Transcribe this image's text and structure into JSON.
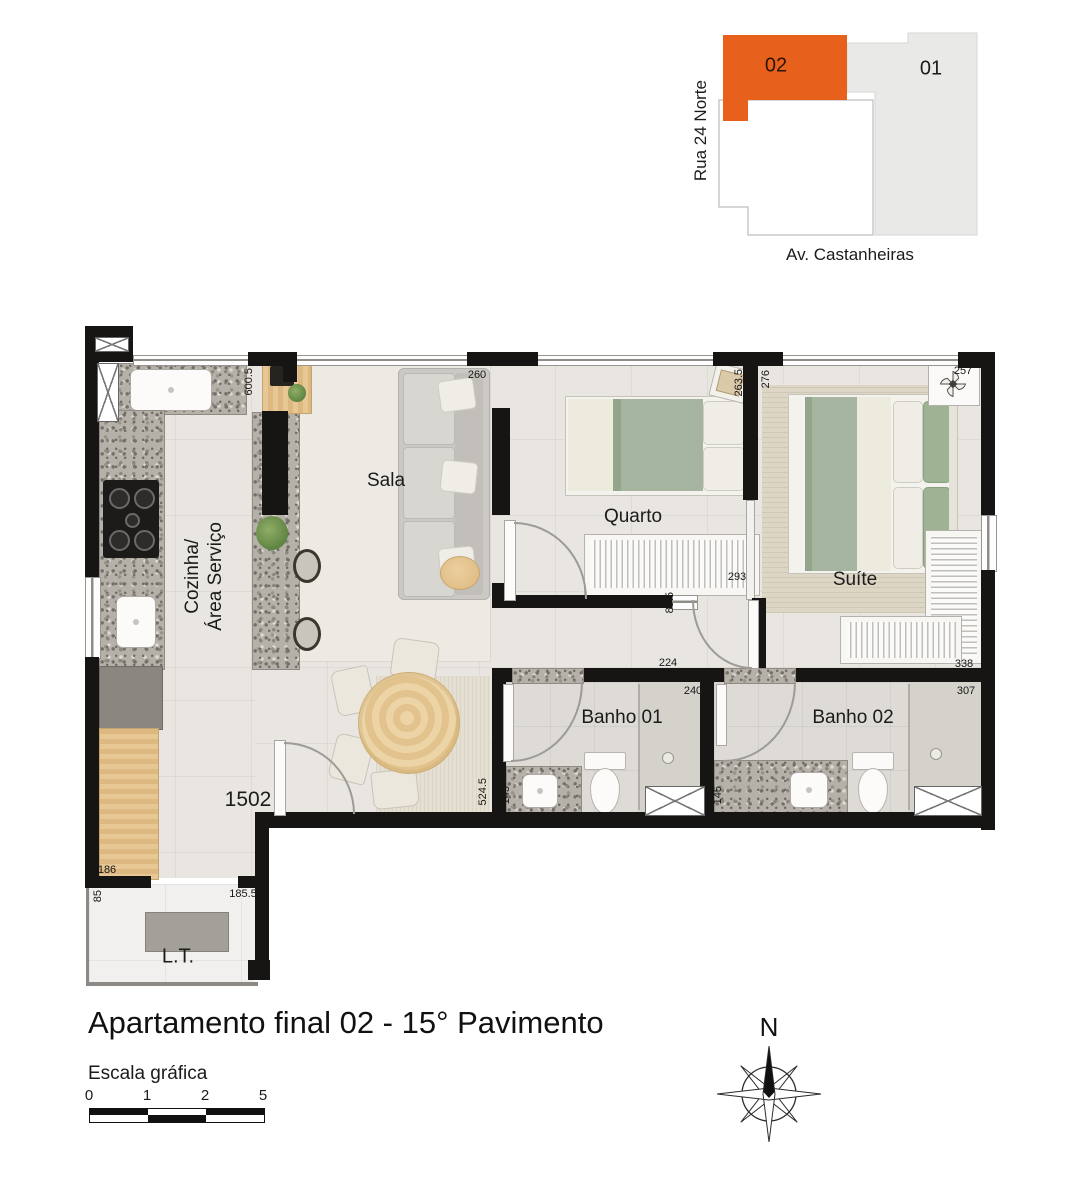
{
  "locator": {
    "street_left": "Rua 24 Norte",
    "street_bottom": "Av. Castanheiras",
    "highlight_unit": "02",
    "other_unit": "01",
    "highlight_color": "#e8611c",
    "other_color": "#e9e9e8"
  },
  "plan": {
    "unit_number": "1502",
    "rooms": {
      "sala": "Sala",
      "quarto": "Quarto",
      "suite": "Suíte",
      "cozinha_line1": "Cozinha/",
      "cozinha_line2": "Área Serviço",
      "banho1": "Banho 01",
      "banho2": "Banho 02",
      "lt": "L.T."
    },
    "dimensions": {
      "kitchen_height": "600.5",
      "sala_width": "260",
      "quarto_width": "263.5",
      "suite_width": "276",
      "suite_corner": "257",
      "quarto_depth": "293",
      "hall_stub": "89.5",
      "corridor": "224",
      "banho1_width": "240",
      "suite_depth": "338",
      "banho2_width": "307",
      "banho1_depth": "145",
      "hall_depth": "524.5",
      "banho2_depth": "145",
      "lt_upper": "186",
      "lt_side": "85",
      "lt_width": "185.5"
    }
  },
  "footer": {
    "title": "Apartamento final 02 - 15° Pavimento",
    "scale_label": "Escala gráfica",
    "scale_ticks": [
      "0",
      "1",
      "2",
      "5"
    ],
    "compass_north": "N"
  }
}
